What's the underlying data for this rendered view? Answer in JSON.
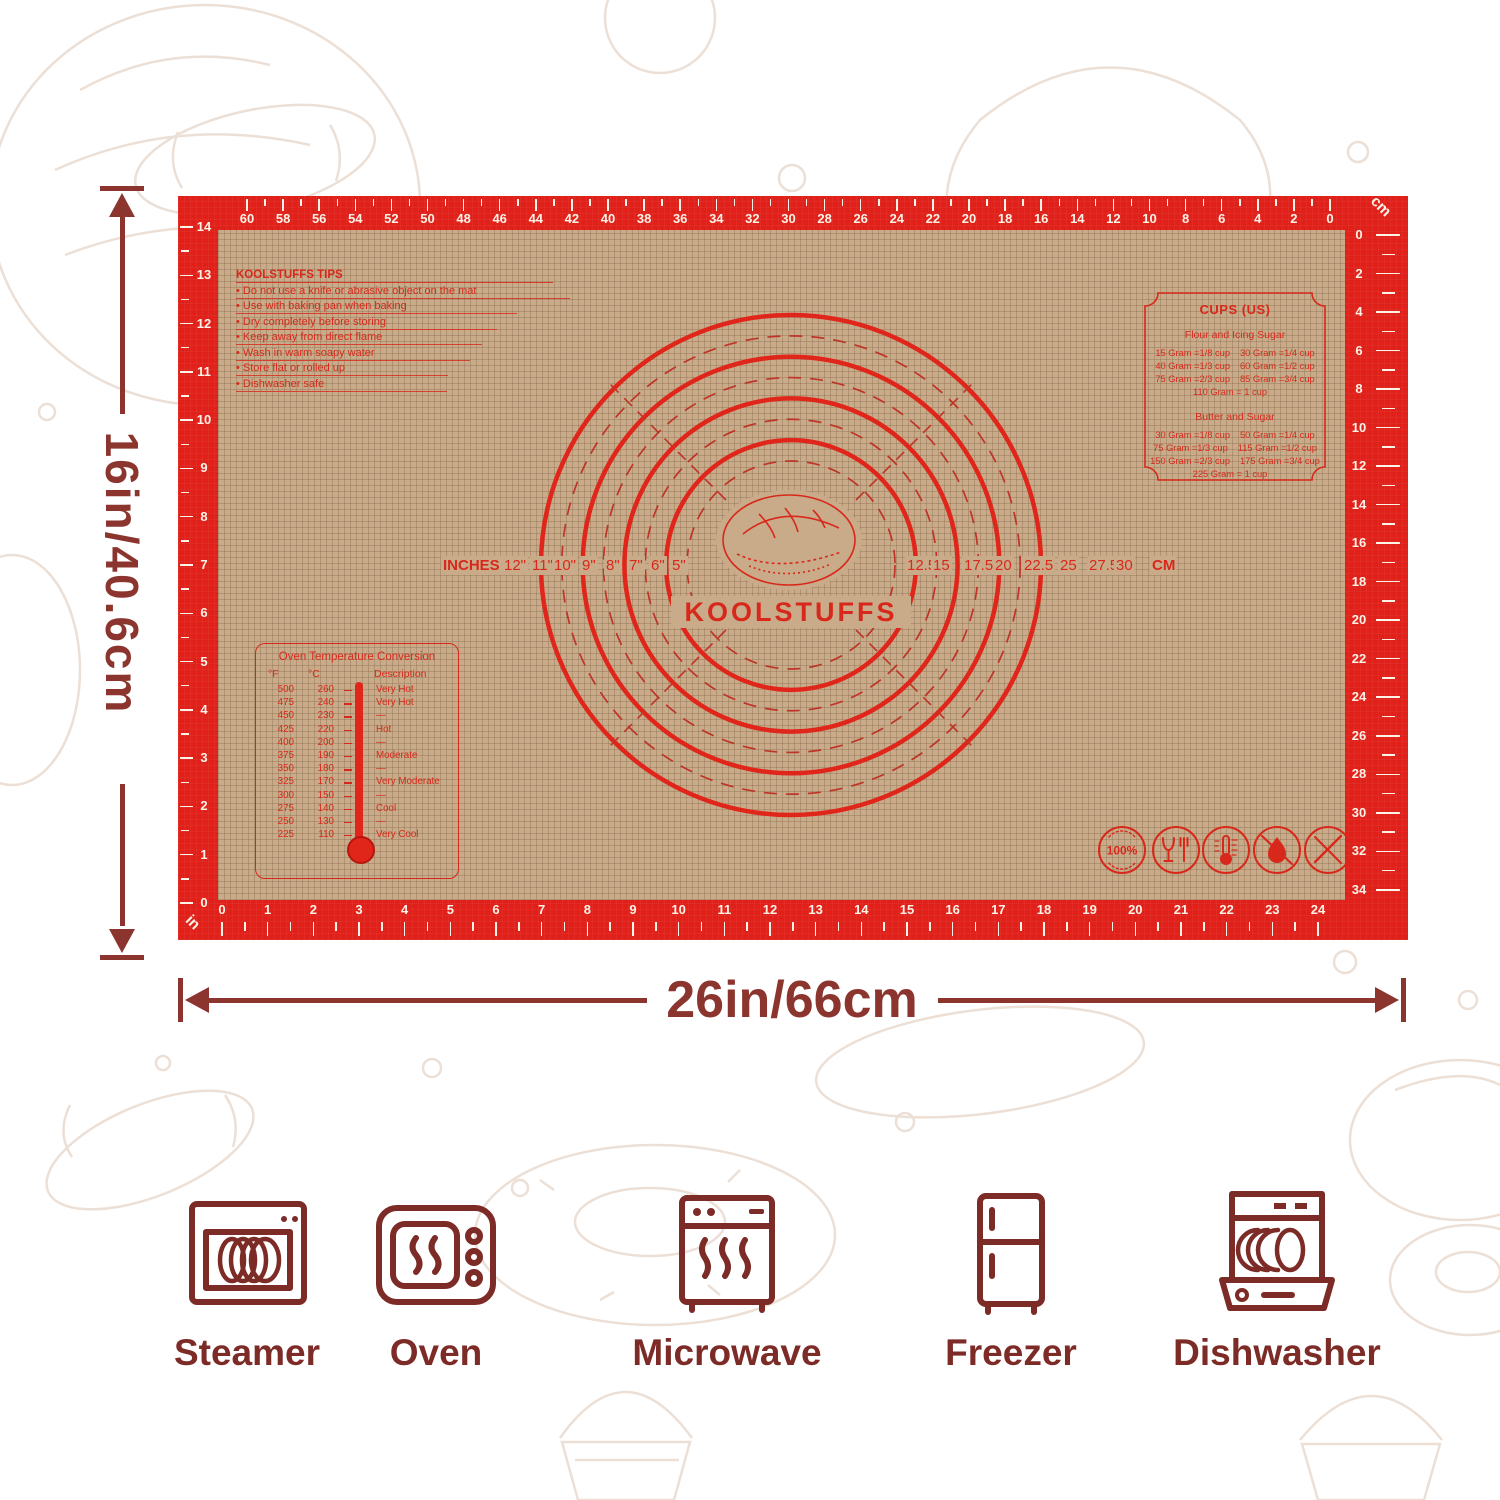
{
  "colors": {
    "mat_red": "#e1201a",
    "mat_tan": "#c9ab89",
    "print_red": "#d8281b",
    "annotation_dark_red": "#8c352f",
    "icon_dark_red": "#7c2b27"
  },
  "dimensions": {
    "height_label": "16in/40.6cm",
    "width_label": "26in/66cm"
  },
  "mat": {
    "brand": "KOOLSTUFFS",
    "tips": {
      "title": "KOOLSTUFFS TIPS",
      "items": [
        "Do not use a knife or abrasive object on the mat",
        "Use with baking pan when baking",
        "Dry completely before storing",
        "Keep away from direct flame",
        "Wash in warm soapy water",
        "Store flat or rolled up",
        "Dishwasher safe"
      ]
    },
    "cups": {
      "title": "CUPS (US)",
      "sections": [
        {
          "heading": "Flour and Icing Sugar",
          "pairs": [
            [
              "15 Gram =1/8 cup",
              "30 Gram =1/4 cup"
            ],
            [
              "40 Gram =1/3 cup",
              "60 Gram =1/2 cup"
            ],
            [
              "75 Gram =2/3 cup",
              "85 Gram =3/4 cup"
            ],
            [
              "110 Gram =  1 cup",
              ""
            ]
          ]
        },
        {
          "heading": "Butter and Sugar",
          "pairs": [
            [
              "30 Gram =1/8 cup",
              "50 Gram =1/4 cup"
            ],
            [
              "75 Gram =1/3 cup",
              "115 Gram =1/2 cup"
            ],
            [
              "150 Gram =2/3 cup",
              "175 Gram =3/4 cup"
            ],
            [
              "225 Gram =  1 cup",
              ""
            ]
          ]
        }
      ]
    },
    "oven": {
      "title": "Oven Temperature Conversion",
      "headers": [
        "°F",
        "°C",
        "Description"
      ],
      "rows": [
        [
          "500",
          "260",
          "Very Hot"
        ],
        [
          "475",
          "240",
          "Very Hot"
        ],
        [
          "450",
          "230",
          "—"
        ],
        [
          "425",
          "220",
          "Hot"
        ],
        [
          "400",
          "200",
          "—"
        ],
        [
          "375",
          "190",
          "Moderate"
        ],
        [
          "350",
          "180",
          "—"
        ],
        [
          "325",
          "170",
          "Very Moderate"
        ],
        [
          "300",
          "150",
          "—"
        ],
        [
          "275",
          "140",
          "Cool"
        ],
        [
          "250",
          "130",
          "—"
        ],
        [
          "225",
          "110",
          "Very Cool"
        ]
      ]
    },
    "circle_gauge": {
      "unit_left": "INCHES",
      "inch_labels": [
        "12\"",
        "11\"",
        "10\"",
        "9\"",
        "8\"",
        "7\"",
        "6\"",
        "5\""
      ],
      "cm_labels": [
        "12.5",
        "15",
        "17.5",
        "20",
        "22.5",
        "25",
        "27.5",
        "30"
      ],
      "unit_right": "CM"
    },
    "rulers": {
      "top_unit": "cm",
      "bottom_unit": "in",
      "top_cm_labels": [
        "60",
        "58",
        "56",
        "54",
        "52",
        "50",
        "48",
        "46",
        "44",
        "42",
        "40",
        "38",
        "36",
        "34",
        "32",
        "30",
        "28",
        "26",
        "24",
        "22",
        "20",
        "18",
        "16",
        "14",
        "12",
        "10",
        "8",
        "6",
        "4",
        "2",
        "0"
      ],
      "bottom_in_labels": [
        "0",
        "1",
        "2",
        "3",
        "4",
        "5",
        "6",
        "7",
        "8",
        "9",
        "10",
        "11",
        "12",
        "13",
        "14",
        "15",
        "16",
        "17",
        "18",
        "19",
        "20",
        "21",
        "22",
        "23",
        "24"
      ],
      "left_in_labels": [
        "14",
        "13",
        "12",
        "11",
        "10",
        "9",
        "8",
        "7",
        "6",
        "5",
        "4",
        "3",
        "2",
        "1",
        "0"
      ],
      "right_cm_labels": [
        "0",
        "2",
        "4",
        "6",
        "8",
        "10",
        "12",
        "14",
        "16",
        "18",
        "20",
        "22",
        "24",
        "26",
        "28",
        "30",
        "32",
        "34"
      ]
    },
    "badges": {
      "percent_label": "100%"
    }
  },
  "appliances": [
    {
      "label": "Steamer"
    },
    {
      "label": "Oven"
    },
    {
      "label": "Microwave"
    },
    {
      "label": "Freezer"
    },
    {
      "label": "Dishwasher"
    }
  ]
}
